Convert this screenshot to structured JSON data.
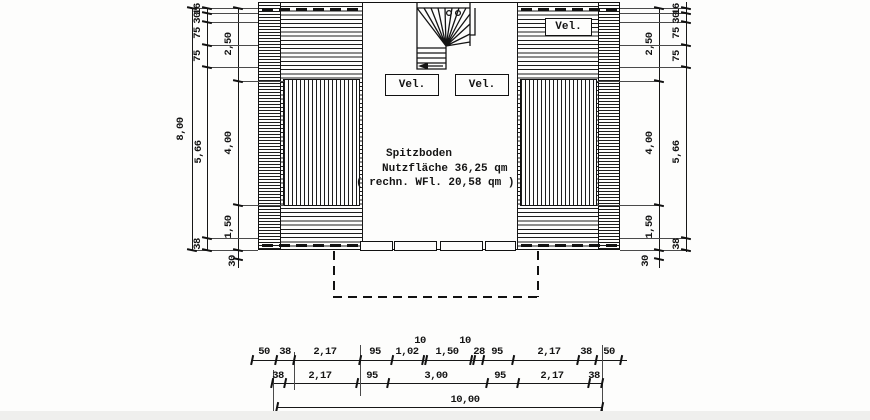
{
  "room": {
    "line1": "Spitzboden",
    "line2": "Nutzfläche 36,25 qm",
    "line3": "( rechn. WFl. 20,58 qm )"
  },
  "labels": {
    "velux": "Vel."
  },
  "dims": {
    "left_total": "8,00",
    "left_outer": [
      "16",
      "30",
      "75",
      "75",
      "5,66",
      "38"
    ],
    "left_inner": [
      "2,50",
      "4,00",
      "1,50",
      "30"
    ],
    "right_inner": [
      "2,50",
      "4,00",
      "1,50",
      "30"
    ],
    "right_outer": [
      "16",
      "30",
      "75",
      "75",
      "5,66",
      "38"
    ],
    "bottom_row1": [
      "50",
      "38",
      "2,17",
      "95",
      "1,02",
      "10",
      "1,50",
      "10",
      "28",
      "95",
      "2,17",
      "38",
      "50"
    ],
    "bottom_row2": [
      "38",
      "2,17",
      "95",
      "3,00",
      "95",
      "2,17",
      "38"
    ],
    "bottom_total": "10,00"
  },
  "colors": {
    "ink": "#141414",
    "paper": "#fdfdfc"
  }
}
